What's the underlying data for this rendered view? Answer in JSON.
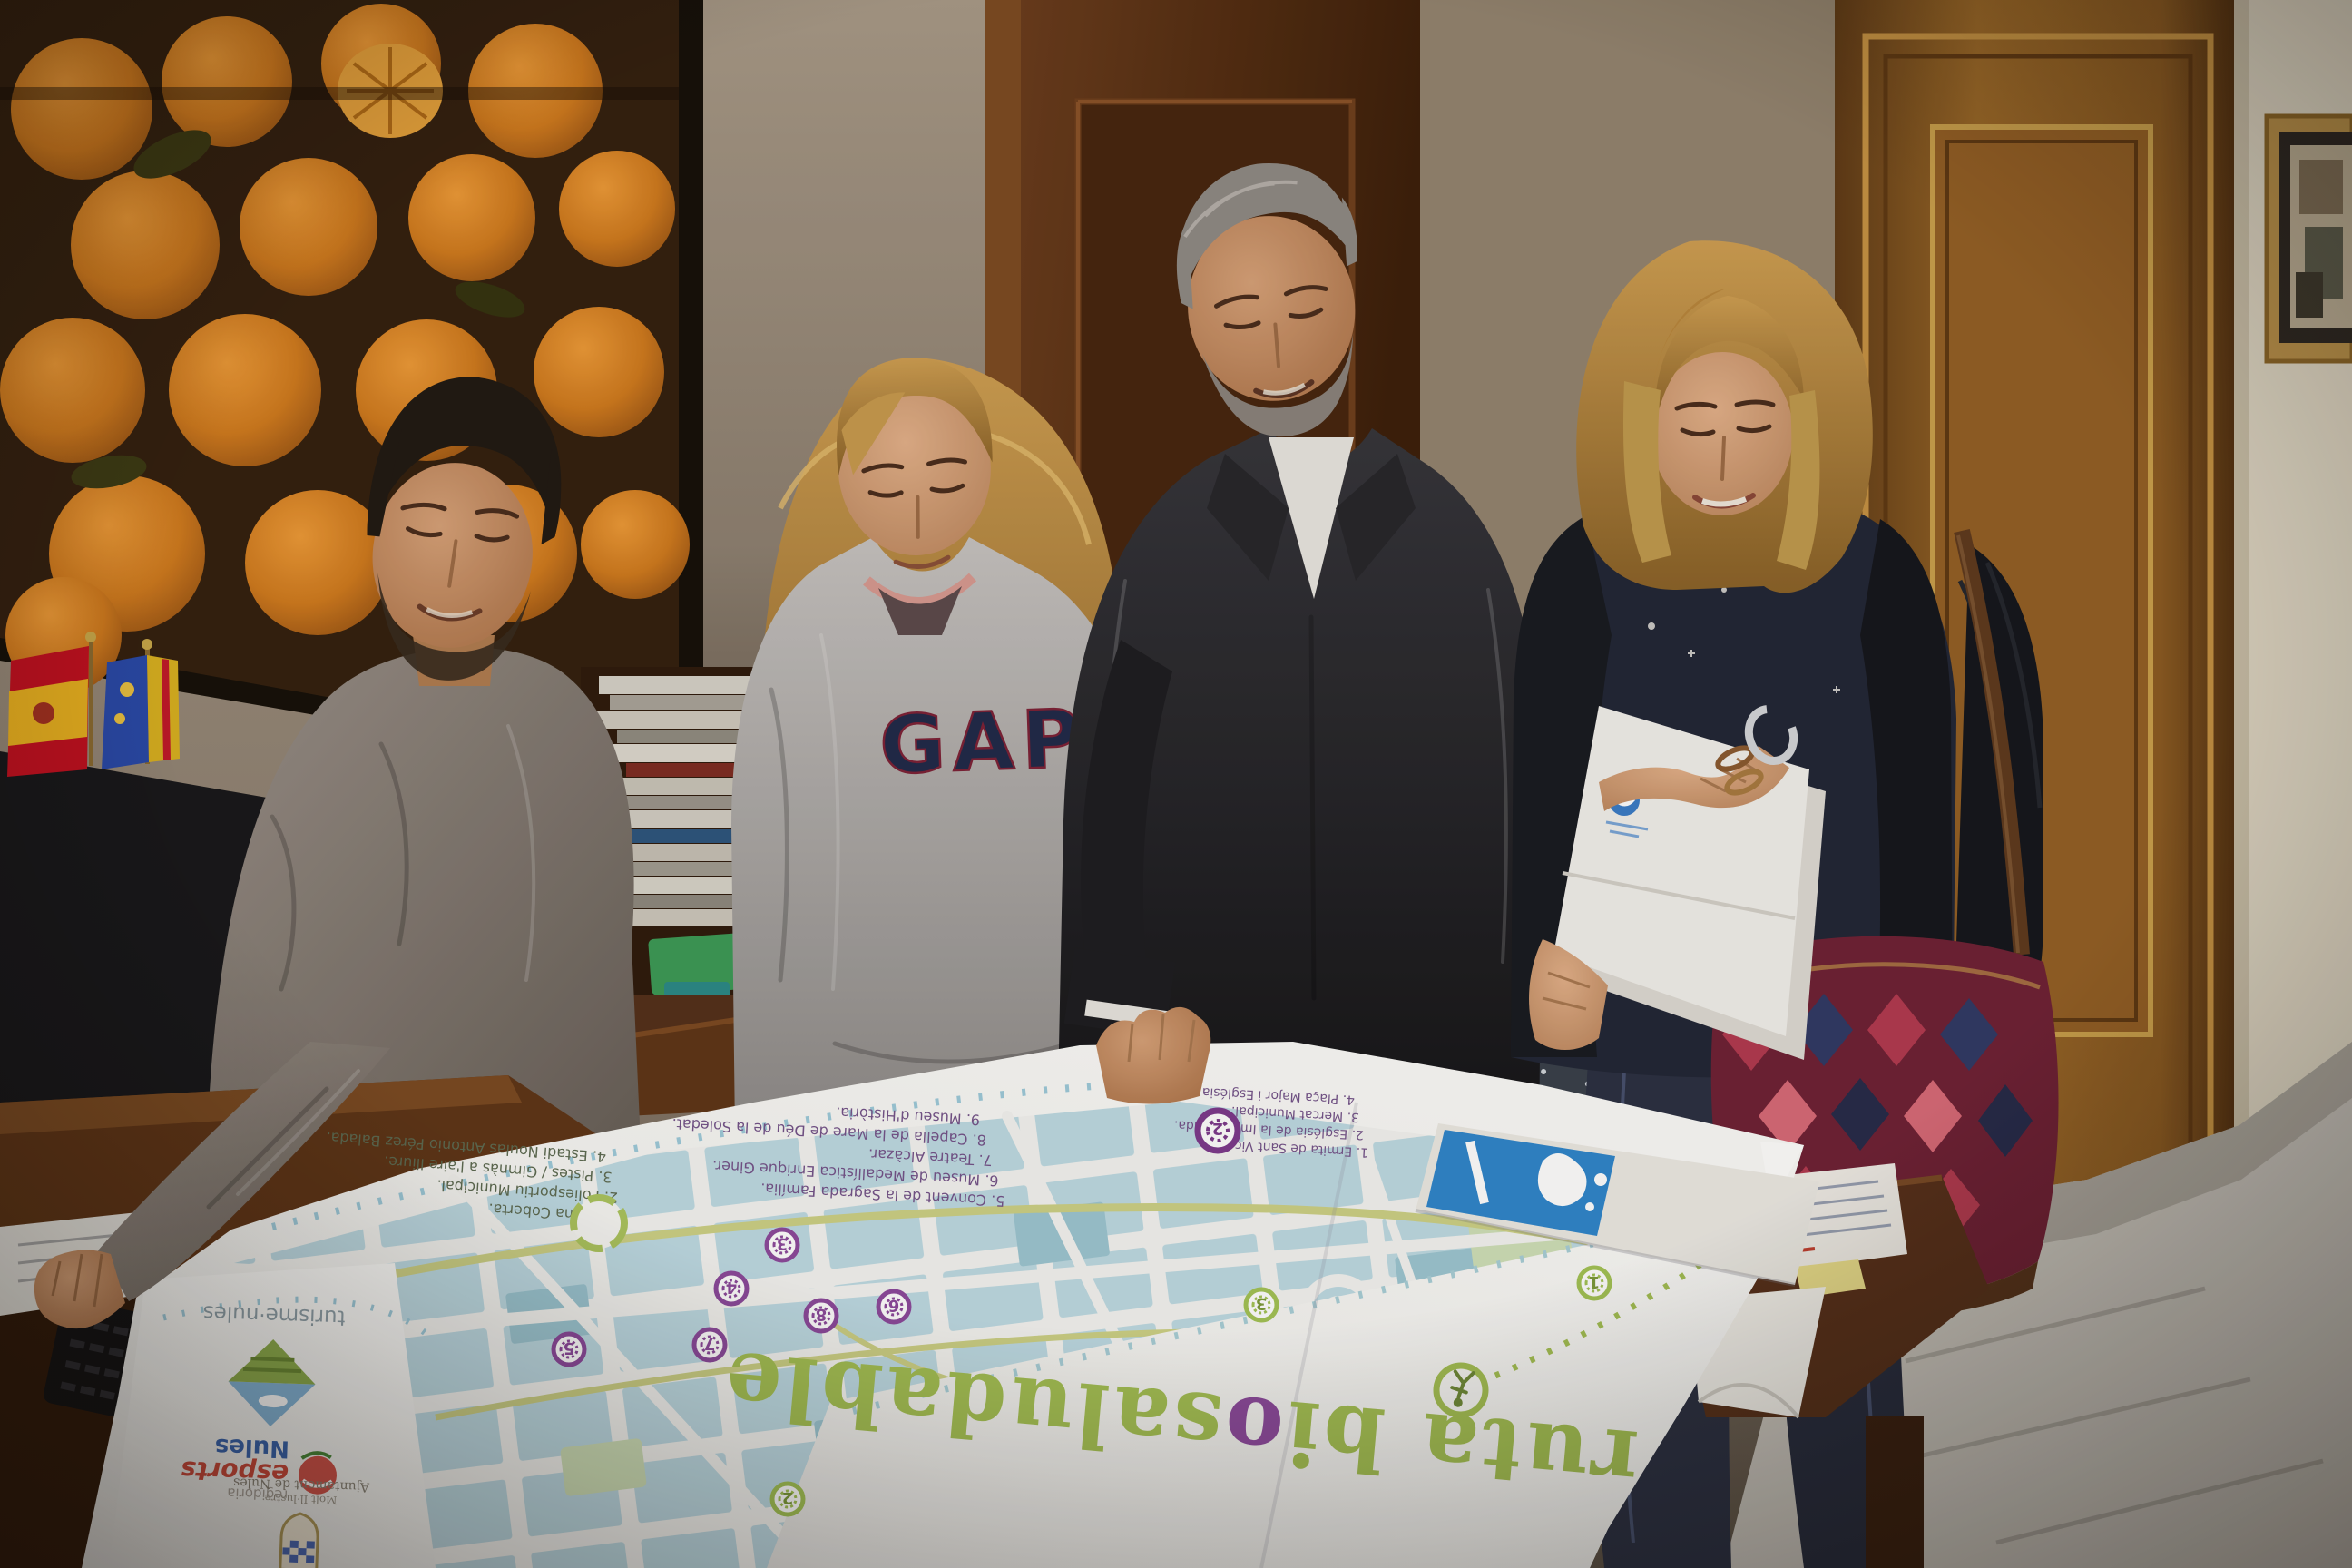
{
  "poster": {
    "title_pre": "ruta bi",
    "title_o": "o",
    "title_post": "saludable",
    "green_list": [
      "1. Piscina Coberta.",
      "2. Poliesportiu Municipal.",
      "3. Pistes / Gimnàs a l'aire lliure.",
      "4. Estadi Noulas Antonio Pérez Balada."
    ],
    "purple_list": [
      "5. Convent de la Sagrada Família.",
      "6. Museu de Medallística Enrique Giner.",
      "7. Teatre Alcàzar.",
      "8. Capella de la Mare de Déu de la Soledat.",
      "9. Museu d'Història."
    ],
    "right_list": [
      "1. Ermita de Sant Vicent.",
      "2. Església de la Immaculada.",
      "3. Mercat Municipal.",
      "4. Plaça Major i Església Arxiprestal."
    ],
    "markers": [
      {
        "n": "8"
      },
      {
        "n": "6"
      },
      {
        "n": "3"
      },
      {
        "n": "4"
      },
      {
        "n": "7"
      },
      {
        "n": "5"
      },
      {
        "n": "2"
      },
      {
        "n": "2"
      },
      {
        "n": "3"
      },
      {
        "n": "1"
      }
    ]
  },
  "logos": {
    "turisme": "turisme·nules",
    "regidoria": "regidoria",
    "esports": "esports",
    "nules": "Nules",
    "ajuntament_line1": "Molt Il·lustre",
    "ajuntament_line2": "Ajuntament de Nules"
  },
  "clothing": {
    "gap_logo": "GAP"
  },
  "colors": {
    "map_title_green": "#a4c054",
    "map_marker_purple": "#8c4a9c",
    "map_marker_green": "#a3c355",
    "map_block_blue": "#bedbe4",
    "route_olive": "#cdd186",
    "brochure_blue": "#2f86cc",
    "gap_navy": "#20294a",
    "esports_red": "#cf4a3c",
    "nules_blue": "#3a66b0"
  }
}
